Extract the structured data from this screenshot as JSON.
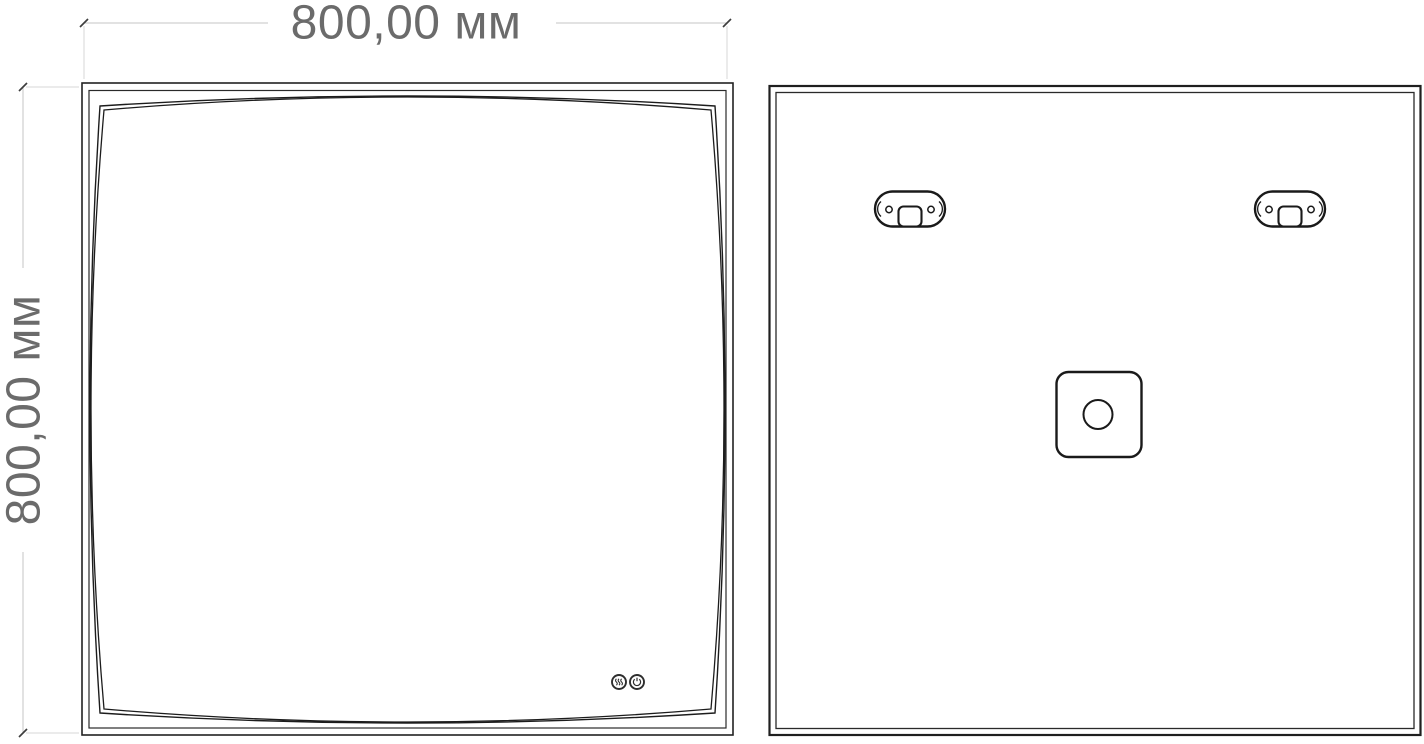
{
  "drawing": {
    "type": "technical-drawing-mirror",
    "background_color": "#ffffff",
    "outline_color": "#1f1f1f",
    "views": {
      "front": {
        "description": "front view of square mirror with curved inner edge",
        "touch_icons": [
          "heated-mirror-icon",
          "power-icon"
        ]
      },
      "back": {
        "description": "back view with two mounting brackets and junction box",
        "icons": [
          "mounting-bracket-icon",
          "mounting-bracket-icon",
          "junction-box-icon"
        ]
      }
    }
  },
  "dimensions": {
    "width_label": "800,00 мм",
    "height_label": "800,00 мм",
    "text_color": "#6b6b6b",
    "line_color": "#c6c6c6",
    "extension_line_color": "#d7d7d7",
    "tick_color": "#3d3d3d"
  }
}
